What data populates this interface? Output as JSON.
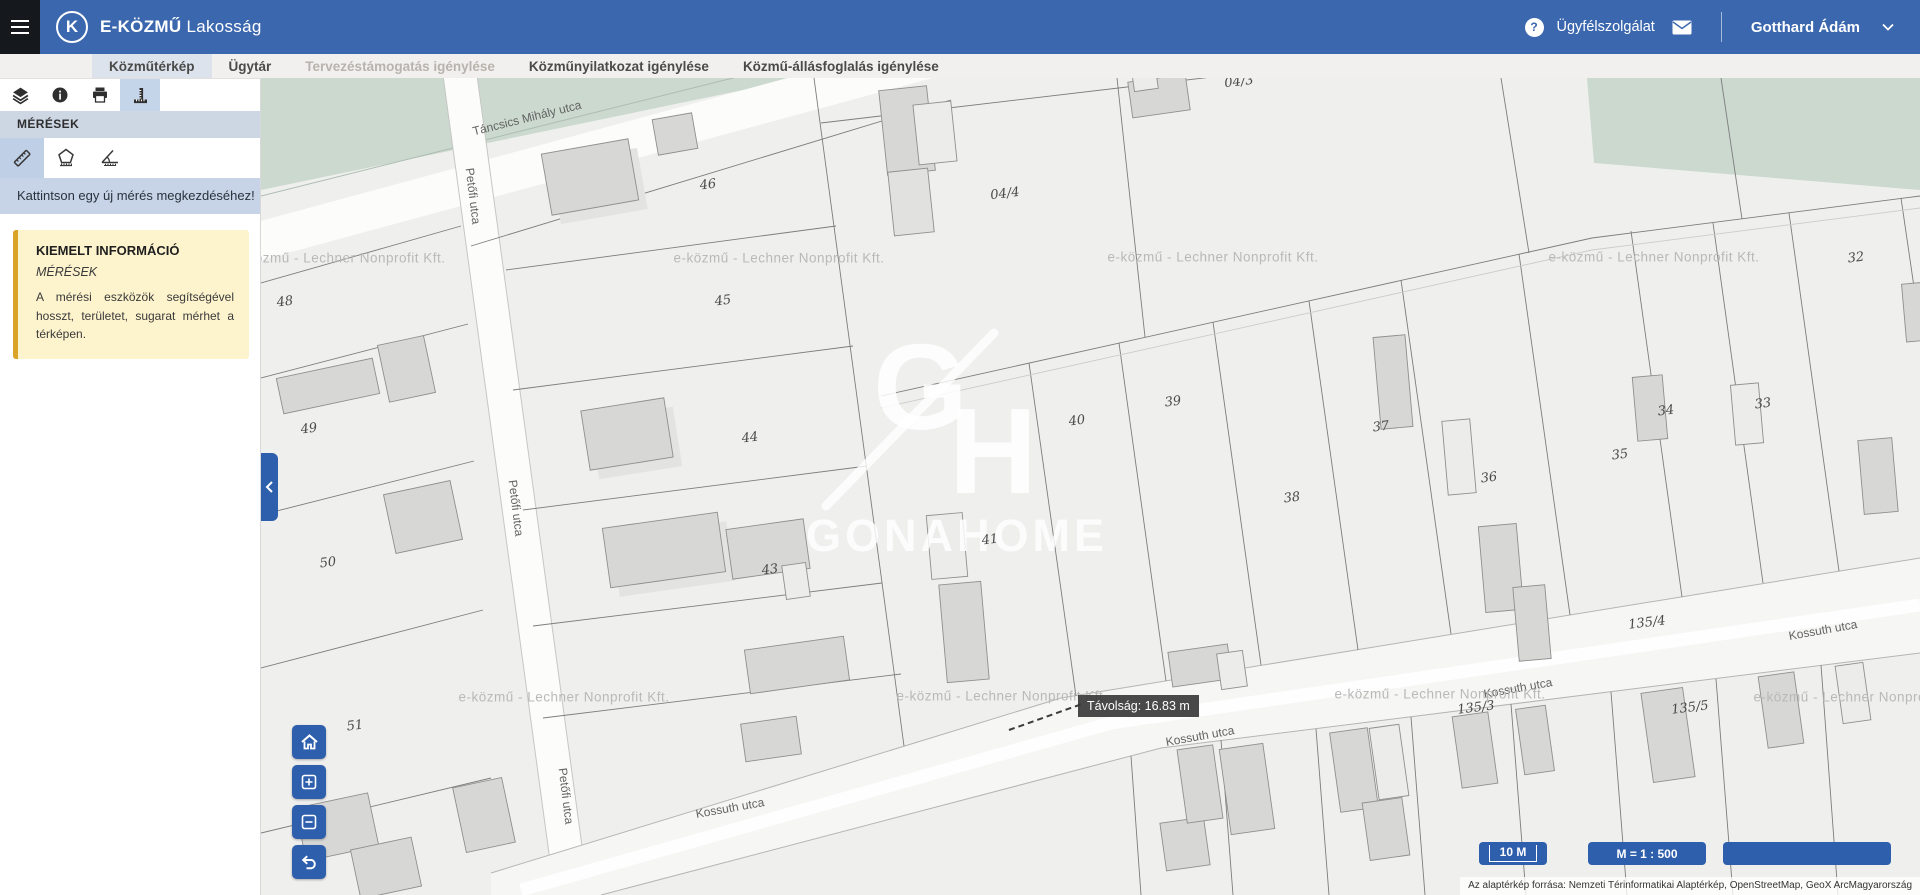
{
  "header": {
    "app_name": "E-KÖZMŰ",
    "app_suffix": "Lakosság",
    "logo_letter": "K",
    "support_label": "Ügyfélszolgálat",
    "user_name": "Gotthard Ádám"
  },
  "tabs": [
    {
      "label": "Közműtérkép",
      "state": "active"
    },
    {
      "label": "Ügytár",
      "state": "normal"
    },
    {
      "label": "Tervezéstámogatás igénylése",
      "state": "disabled"
    },
    {
      "label": "Közműnyilatkozat igénylése",
      "state": "normal"
    },
    {
      "label": "Közmű-állásfoglalás igénylése",
      "state": "normal"
    }
  ],
  "sidebar": {
    "panel_title": "MÉRÉSEK",
    "toolbar_icons": [
      "layers",
      "info",
      "print",
      "measure"
    ],
    "measure_tools": [
      "length",
      "area",
      "radius"
    ],
    "hint": "Kattintson egy új mérés megkezdéséhez!",
    "info_box": {
      "title": "KIEMELT INFORMÁCIÓ",
      "subtitle": "MÉRÉSEK",
      "body": "A mérési eszközök segítségével hosszt, területet, sugarat mérhet a térképen."
    }
  },
  "map": {
    "tooltip": "Távolság: 16.83 m",
    "scale_bar": "10 M",
    "scale_ratio": "M = 1 : 500",
    "attribution": "Az alaptérkép forrása: Nemzeti Térinformatikai Alaptérkép, OpenStreetMap, GeoX ArcMagyarország",
    "watermark_text": "e-közmű - Lechner Nonprofit Kft.",
    "brand": {
      "monogram_g": "G",
      "monogram_h": "H",
      "name": "GONAHOME"
    },
    "street_labels": [
      {
        "t": "Táncsics Mihály utca",
        "x": 266,
        "y": 40,
        "r": -14
      },
      {
        "t": "Petőfi utca",
        "x": 212,
        "y": 118,
        "r": 83
      },
      {
        "t": "Petőfi utca",
        "x": 255,
        "y": 430,
        "r": 83
      },
      {
        "t": "Petőfi utca",
        "x": 305,
        "y": 718,
        "r": 83
      },
      {
        "t": "Kossuth utca",
        "x": 469,
        "y": 730,
        "r": -10
      },
      {
        "t": "Kossuth utca",
        "x": 939,
        "y": 658,
        "r": -10
      },
      {
        "t": "Kossuth utca",
        "x": 1257,
        "y": 610,
        "r": -10
      },
      {
        "t": "Kossuth utca",
        "x": 1562,
        "y": 552,
        "r": -10
      }
    ],
    "parcel_labels": [
      {
        "t": "46",
        "x": 447,
        "y": 107
      },
      {
        "t": "45",
        "x": 462,
        "y": 223
      },
      {
        "t": "44",
        "x": 489,
        "y": 360
      },
      {
        "t": "43",
        "x": 509,
        "y": 492
      },
      {
        "t": "48",
        "x": 24,
        "y": 224
      },
      {
        "t": "49",
        "x": 48,
        "y": 351
      },
      {
        "t": "50",
        "x": 67,
        "y": 485
      },
      {
        "t": "51",
        "x": 94,
        "y": 648
      },
      {
        "t": "04/4",
        "x": 744,
        "y": 116
      },
      {
        "t": "04/3",
        "x": 978,
        "y": 4
      },
      {
        "t": "41",
        "x": 729,
        "y": 462
      },
      {
        "t": "40",
        "x": 816,
        "y": 343
      },
      {
        "t": "39",
        "x": 912,
        "y": 324
      },
      {
        "t": "38",
        "x": 1031,
        "y": 420
      },
      {
        "t": "37",
        "x": 1120,
        "y": 349
      },
      {
        "t": "36",
        "x": 1228,
        "y": 400
      },
      {
        "t": "35",
        "x": 1359,
        "y": 377
      },
      {
        "t": "34",
        "x": 1405,
        "y": 333
      },
      {
        "t": "33",
        "x": 1502,
        "y": 326
      },
      {
        "t": "32",
        "x": 1595,
        "y": 180
      },
      {
        "t": "135/4",
        "x": 1386,
        "y": 545
      },
      {
        "t": "135/3",
        "x": 1215,
        "y": 630
      },
      {
        "t": "135/5",
        "x": 1429,
        "y": 630
      }
    ],
    "watermarks": [
      {
        "x": 79,
        "y": 180
      },
      {
        "x": 518,
        "y": 180
      },
      {
        "x": 952,
        "y": 179
      },
      {
        "x": 1393,
        "y": 179
      },
      {
        "x": 303,
        "y": 619
      },
      {
        "x": 741,
        "y": 618
      },
      {
        "x": 1179,
        "y": 616
      },
      {
        "x": 1598,
        "y": 619
      }
    ]
  },
  "colors": {
    "header_blue": "#3b67ae",
    "accent_blue": "#2e5fad",
    "selection_blue": "#c4d4e9",
    "panel_strip": "#cdd7e4",
    "hint_bg": "#c7d4e7",
    "info_bg": "#fdf3cd",
    "info_border": "#d9a427",
    "map_green": "#cbd9cf",
    "map_bg": "#efefee"
  }
}
